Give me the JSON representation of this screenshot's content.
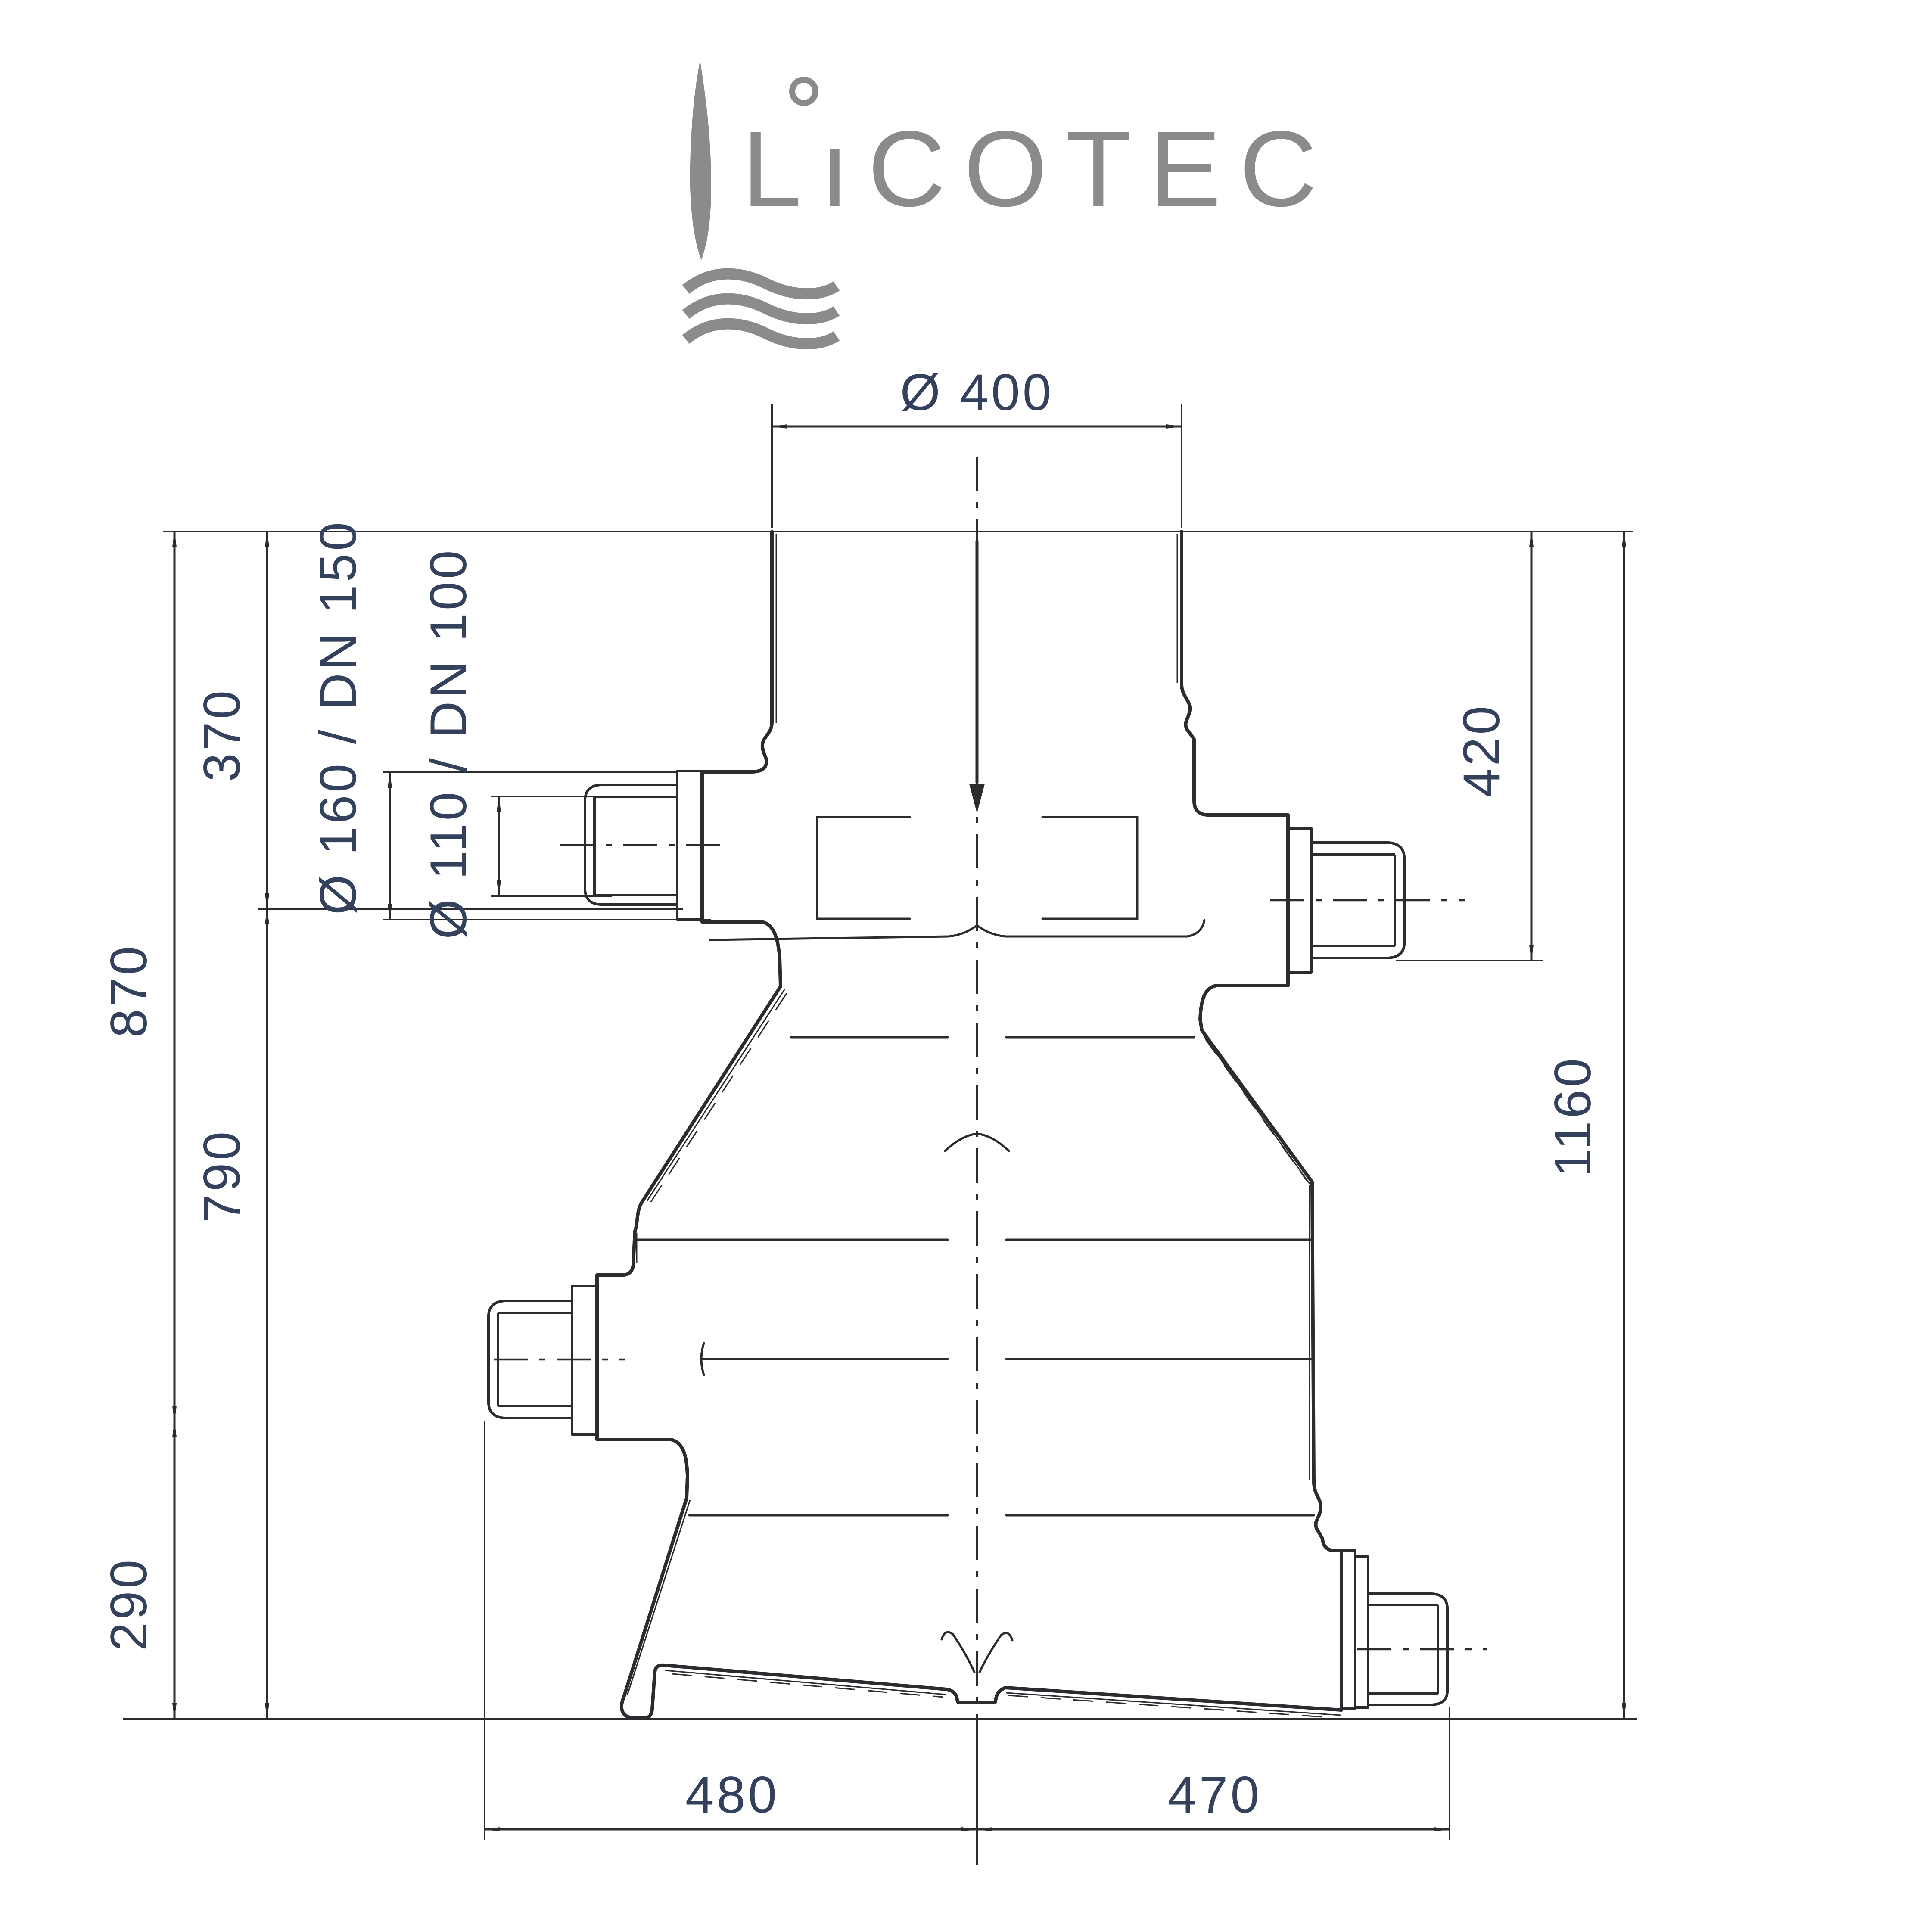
{
  "logo": {
    "brand": "LıCOTEC",
    "brand_plain": "LICOTEC",
    "color": "#8b8b8b",
    "icons": [
      "leaf-blade-icon",
      "water-waves-icon",
      "i-ring-dot-icon"
    ]
  },
  "drawing": {
    "kind": "technical dimension drawing - tank / filter vessel section",
    "line_color": "#2b2b30",
    "dim_text_color": "#33415c",
    "labels": {
      "top_diameter": "Ø 400",
      "inlet_socket": "Ø 160 / DN 150",
      "inlet_pipe": "Ø 110 / DN 100",
      "left_inner_top": "370",
      "left_outer_top": "870",
      "left_inner_bottom": "790",
      "left_outer_bottom": "290",
      "right_top": "420",
      "total_height": "1160",
      "bottom_left_half": "480",
      "bottom_right_half": "470"
    }
  }
}
